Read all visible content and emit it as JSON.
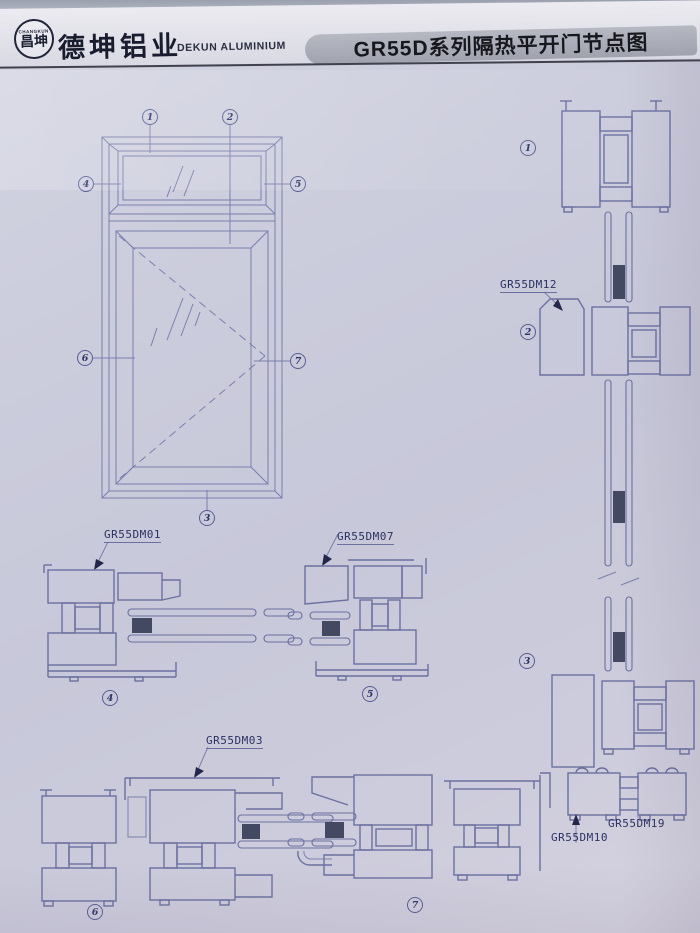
{
  "colors": {
    "paper": "#cbccdc",
    "line": "#6b70a0",
    "dark_spacer": "#434960",
    "title_band": "#a8aab5",
    "ink": "#17181d"
  },
  "header": {
    "logo_arc_text": "CHANGKUN",
    "logo_text": "昌坤",
    "company_cn": "德坤铝业",
    "company_en": "DEKUN ALUMINIUM",
    "title": "GR55D系列隔热平开门节点图"
  },
  "callouts": {
    "n1": "1",
    "n2": "2",
    "n3": "3",
    "n4": "4",
    "n5": "5",
    "n6": "6",
    "n7": "7"
  },
  "part_labels": {
    "dm01": "GR55DM01",
    "dm07": "GR55DM07",
    "dm03": "GR55DM03",
    "dm12": "GR55DM12",
    "dm10": "GR55DM10",
    "dm19": "GR55DM19"
  }
}
